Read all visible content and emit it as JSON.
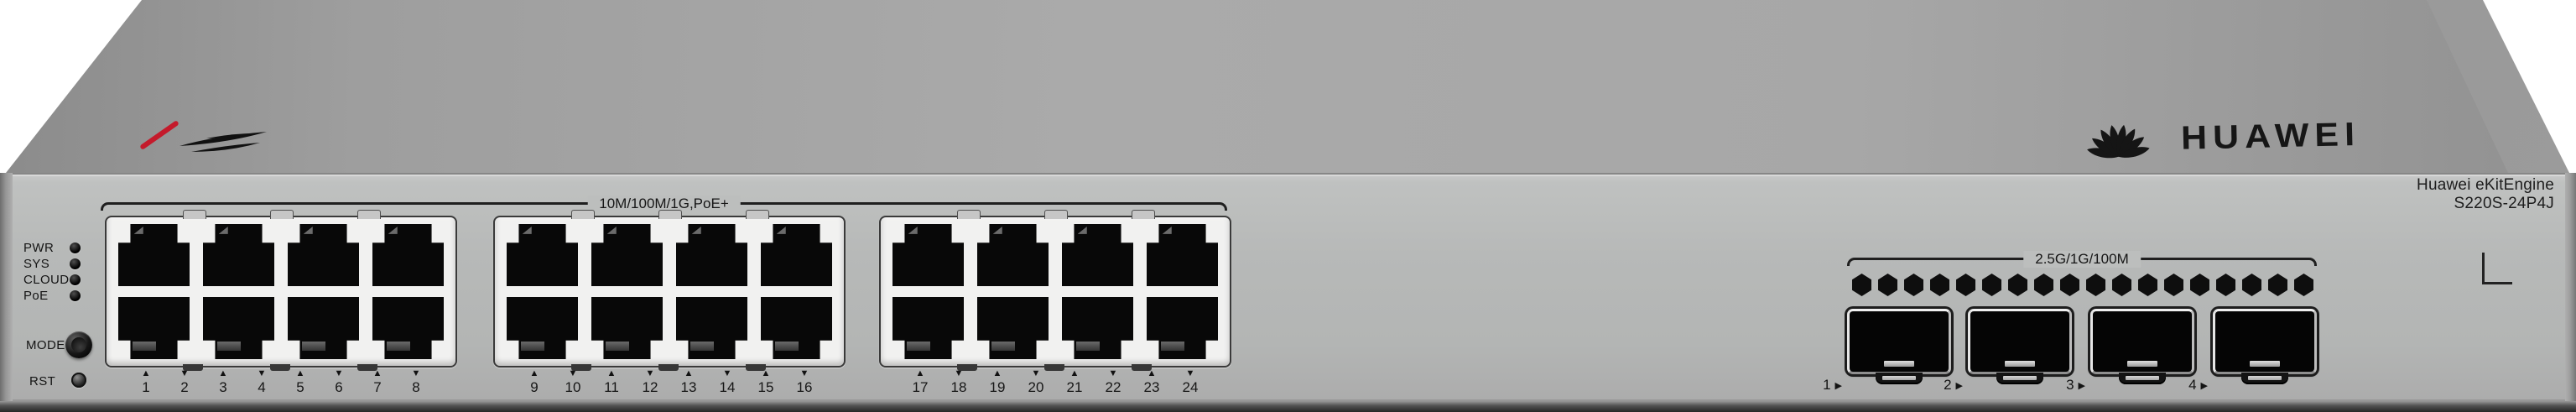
{
  "device": {
    "brand": "HUAWEI",
    "series": "Huawei eKitEngine",
    "model": "S220S-24P4J"
  },
  "front_panel": {
    "leds": [
      {
        "label": "PWR"
      },
      {
        "label": "SYS"
      },
      {
        "label": "CLOUD"
      },
      {
        "label": "PoE"
      }
    ],
    "mode_button": {
      "label": "MODE"
    },
    "reset_button": {
      "label": "RST"
    },
    "rj45_section": {
      "speed_label": "10M/100M/1G,PoE+",
      "groups": [
        {
          "ports": [
            "1",
            "2",
            "3",
            "4",
            "5",
            "6",
            "7",
            "8"
          ]
        },
        {
          "ports": [
            "9",
            "10",
            "11",
            "12",
            "13",
            "14",
            "15",
            "16"
          ]
        },
        {
          "ports": [
            "17",
            "18",
            "19",
            "20",
            "21",
            "22",
            "23",
            "24"
          ]
        }
      ]
    },
    "sfp_section": {
      "speed_label": "2.5G/1G/100M",
      "ports": [
        "1",
        "2",
        "3",
        "4"
      ],
      "vent_hole_count": 18
    }
  },
  "icons": {
    "port_up_triangle": "▲",
    "port_down_triangle": "▼",
    "sfp_arrow": "▶"
  },
  "colors": {
    "chassis_top": "#9d9d9d",
    "chassis_front": "#b6b8b7",
    "port_bezel": "#f1f1f0",
    "jack_black": "#080808",
    "accent_red": "#c41a2b",
    "label_text": "#161616"
  }
}
